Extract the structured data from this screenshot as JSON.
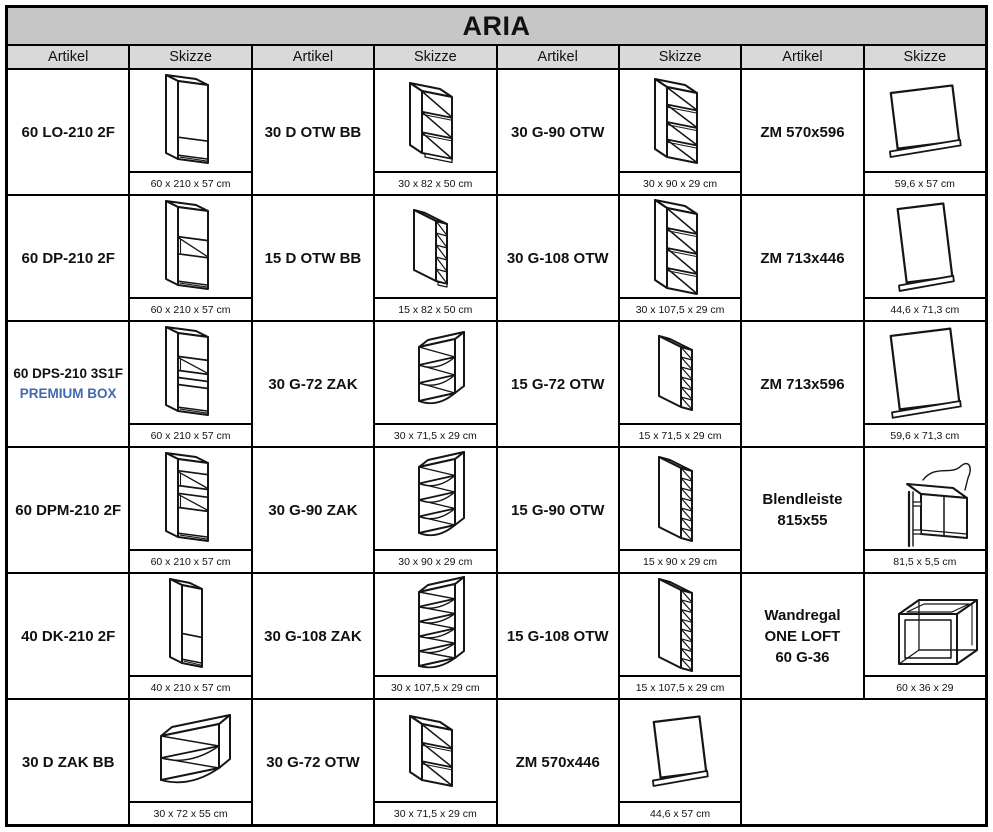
{
  "title": "ARIA",
  "headers": [
    "Artikel",
    "Skizze",
    "Artikel",
    "Skizze",
    "Artikel",
    "Skizze",
    "Artikel",
    "Skizze"
  ],
  "colors": {
    "title_bg": "#c6c6c6",
    "header_bg": "#d9d9d9",
    "premium_text": "#4169b1",
    "border": "#000000"
  },
  "rows": [
    [
      {
        "artikel": "60 LO-210 2F",
        "dim": "60 x 210 x 57 cm",
        "sketch": "tall|div:0.72|plinth"
      },
      {
        "artikel": "30 D OTW BB",
        "dim": "30 x 82 x 50 cm",
        "sketch": "otwWide|3|62|plinth"
      },
      {
        "artikel": "30 G-90 OTW",
        "dim": "30 x 90 x 29 cm",
        "sketch": "otwWide|4|70"
      },
      {
        "artikel": "ZM 570x596",
        "dim": "59,6 x 57 cm",
        "sketch": "panel|62|56"
      }
    ],
    [
      {
        "artikel": "60 DP-210 2F",
        "dim": "60 x 210 x 57 cm",
        "sketch": "tall|niche:0.38-0.60|plinth"
      },
      {
        "artikel": "15 D OTW BB",
        "dim": "15 x 82 x 50 cm",
        "sketch": "otwNarrow|5|60|plinth"
      },
      {
        "artikel": "30 G-108 OTW",
        "dim": "30 x 107,5 x 29 cm",
        "sketch": "otwWide|4|80"
      },
      {
        "artikel": "ZM 713x446",
        "dim": "44,6 x 71,3 cm",
        "sketch": "panel|46|74"
      }
    ],
    [
      {
        "artikel": "60 DPS-210 3S1F",
        "sub": "PREMIUM BOX",
        "dim": "60 x 210 x 57 cm",
        "sketch": "tall|niche:0.30-0.48|div:0.57|div:0.66|plinth"
      },
      {
        "artikel": "30 G-72 ZAK",
        "dim": "30 x 71,5 x 29 cm",
        "sketch": "zak|3|54"
      },
      {
        "artikel": "15 G-72 OTW",
        "dim": "15 x 71,5 x 29 cm",
        "sketch": "otwNarrow|6|60"
      },
      {
        "artikel": "ZM 713x596",
        "dim": "59,6 x 71,3 cm",
        "sketch": "panel|60|74"
      }
    ],
    [
      {
        "artikel": "60 DPM-210 2F",
        "dim": "60 x 210 x 57 cm",
        "sketch": "tall|niche:0.15-0.34|niche:0.44-0.62|plinth"
      },
      {
        "artikel": "30 G-90 ZAK",
        "dim": "30 x 90 x 29 cm",
        "sketch": "zak|4|66"
      },
      {
        "artikel": "15 G-90 OTW",
        "dim": "15 x 90 x 29 cm",
        "sketch": "otwNarrow|7|70"
      },
      {
        "artikel": "Blendleiste\n815x55",
        "dim": "81,5 x 5,5 cm",
        "sketch": "blend"
      }
    ],
    [
      {
        "artikel": "40 DK-210 2F",
        "dim": "40 x 210 x 57 cm",
        "sketch": "tall|narrow|div:0.62|plinth"
      },
      {
        "artikel": "30 G-108 ZAK",
        "dim": "30 x 107,5 x 29 cm",
        "sketch": "zak|5|74"
      },
      {
        "artikel": "15 G-108 OTW",
        "dim": "15 x 107,5 x 29 cm",
        "sketch": "otwNarrow|8|78"
      },
      {
        "artikel": "Wandregal\nONE LOFT\n60 G-36",
        "dim": "60 x 36 x 29",
        "sketch": "frame"
      }
    ],
    [
      {
        "artikel": "30 D ZAK BB",
        "dim": "30 x 72 x 55 cm",
        "sketch": "zakLow"
      },
      {
        "artikel": "30 G-72 OTW",
        "dim": "30 x 71,5 x 29 cm",
        "sketch": "otwWide|3|56"
      },
      {
        "artikel": "ZM 570x446",
        "dim": "44,6 x 57 cm",
        "sketch": "panel|46|56"
      }
    ]
  ]
}
